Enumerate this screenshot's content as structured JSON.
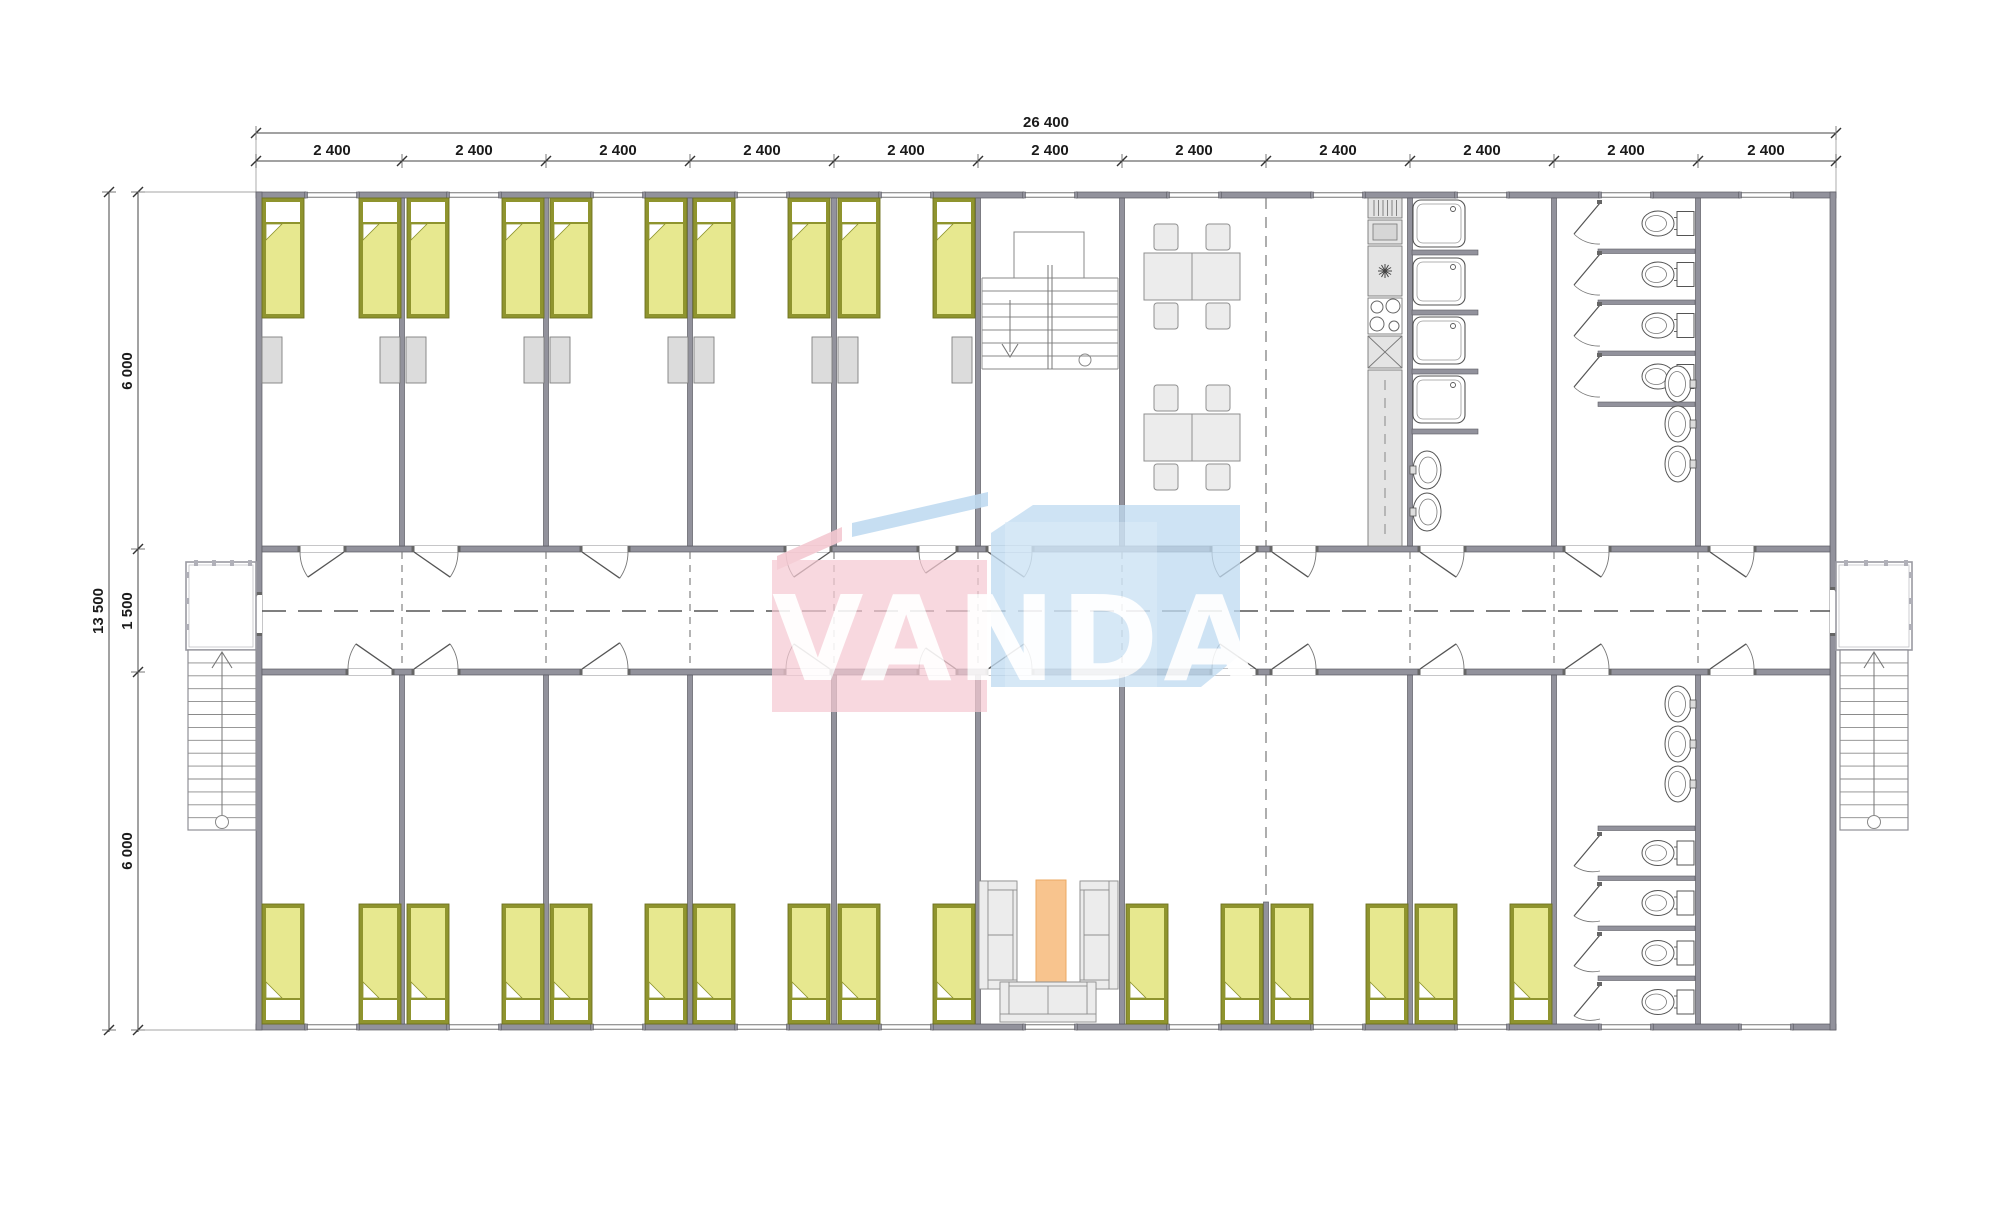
{
  "page": {
    "description": "Architectural floor plan drawing of a modular dormitory building, watermarked VANDA",
    "background": "#ffffff"
  },
  "dimensions": {
    "top_total": "26 400",
    "top_segments": [
      "2 400",
      "2 400",
      "2 400",
      "2 400",
      "2 400",
      "2 400",
      "2 400",
      "2 400",
      "2 400",
      "2 400",
      "2 400"
    ],
    "left_total": "13 500",
    "left_segments": [
      "6 000",
      "1 500",
      "6 000"
    ]
  },
  "watermark": {
    "text": "VANDA",
    "blue": "#c0dbf1",
    "blue_light": "#d9e9f7",
    "pink": "#f5c9d2",
    "text_color": "rgba(255,255,255,0.94)"
  },
  "colors": {
    "wall": "#92929c",
    "wall_edge": "#5c5c64",
    "bed_frame": "#8f942e",
    "bed_frame_edge": "#6e7220",
    "bed_fill": "#e7e88f",
    "pillow": "#ffffff",
    "locker": "#dcdcdc",
    "locker_edge": "#7f7f7f",
    "furniture": "#ececec",
    "furniture_edge": "#8f8f8f",
    "fixture": "#555555",
    "stair": "#8a8a8a",
    "rug": "#f8c48e",
    "rug_edge": "#eba963",
    "dash": "#666666",
    "dim_line": "#444444"
  },
  "rooms": {
    "upper": [
      "bedroom",
      "bedroom",
      "bedroom",
      "bedroom",
      "bedroom",
      "stairwell",
      "dining-room",
      "kitchen",
      "washroom",
      "toilet-room",
      "room"
    ],
    "lower": [
      "bedroom",
      "bedroom",
      "bedroom",
      "bedroom",
      "bedroom",
      "lounge",
      "bedroom",
      "bedroom",
      "bedroom",
      "toilet-room",
      "room"
    ],
    "corridor": "corridor",
    "exterior": [
      "external-staircase-left",
      "external-staircase-right"
    ]
  },
  "fixtures": {
    "beds": 26,
    "wardrobes": 10,
    "dining_table_groups": 2,
    "dining_chairs": 8,
    "kitchen_units": 6,
    "showers": 4,
    "wash_basins": 8,
    "toilets": 8,
    "wc_stall_doors": 8,
    "sofas": 3,
    "rugs": 1,
    "internal_staircases": 1,
    "external_staircases": 2,
    "windows": 22,
    "room_doors": 22,
    "exterior_doors": 2
  }
}
